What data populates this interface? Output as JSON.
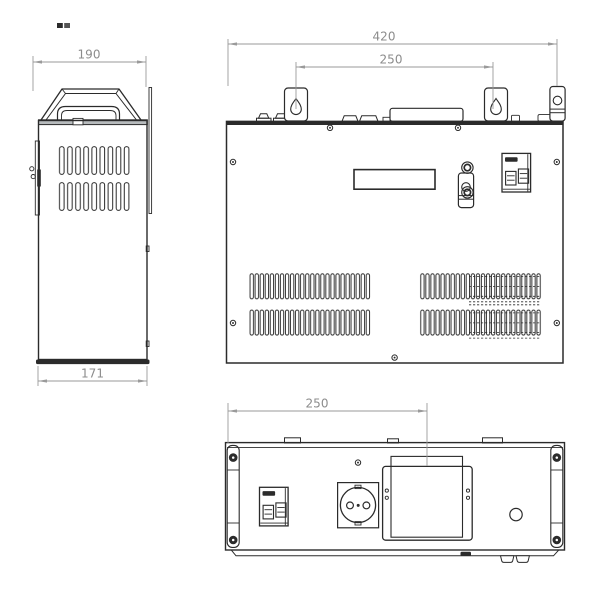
{
  "page": {
    "background": "#ffffff"
  },
  "colors": {
    "outline": "#2b2b2b",
    "dimension_lines": "#9a9a9a",
    "dimension_text": "#8c8c8c"
  },
  "drawing": {
    "type": "technical-drawing",
    "side_view": {
      "dim_top_width": "190",
      "dim_bottom_width": "171"
    },
    "front_view": {
      "dim_overall_width": "420",
      "dim_mount_hole_spacing": "250"
    },
    "rear_view": {
      "dim_terminal_box_offset": "250"
    }
  }
}
